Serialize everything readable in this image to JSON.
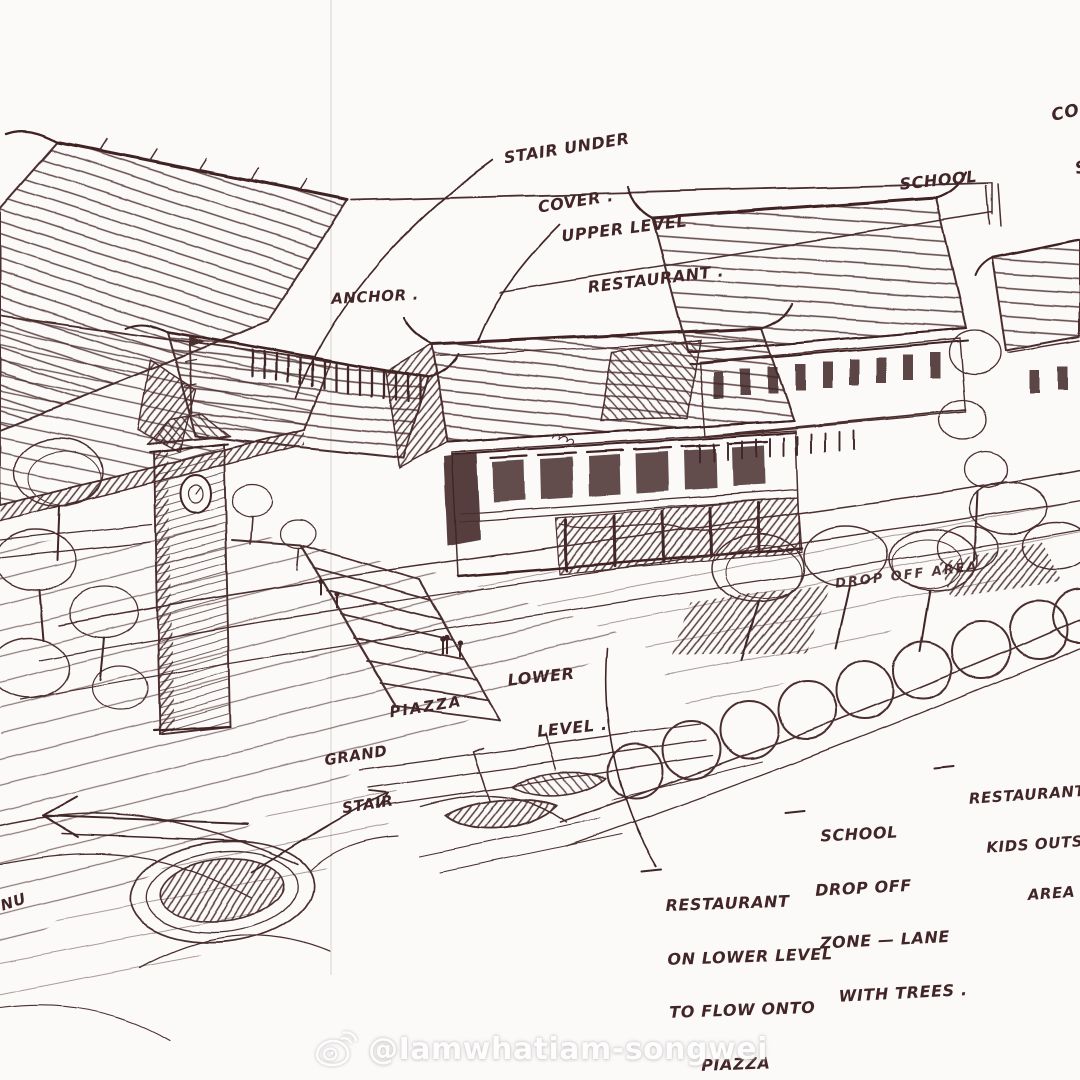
{
  "scene": {
    "type": "architectural-concept-sketch",
    "medium": "pen-on-paper perspective sketch",
    "subjects": [
      "anchor building with pitched roofs",
      "clock tower",
      "grand stair",
      "piazza with figures",
      "two-storey upper-level restaurant shophouse",
      "school building",
      "tree-lined drop-off lane",
      "row of round lane trees",
      "boats on water",
      "pond / roundabout",
      "road arrows"
    ]
  },
  "palette": {
    "ink": "#4b2e2e",
    "ink_dark": "#3f2424",
    "paper": "#fbfaf9",
    "crease": "#e8e3e1",
    "watermark": "#ffffff"
  },
  "annotations": {
    "stair_under_cover": {
      "lines": [
        "STAIR UNDER",
        "COVER ."
      ]
    },
    "upper_level_restaurant": {
      "lines": [
        "UPPER LEVEL",
        "RESTAURANT ."
      ]
    },
    "school": {
      "lines": [
        "SCHOOL"
      ]
    },
    "corner_cutoff": {
      "lines": [
        "CO",
        "S"
      ]
    },
    "anchor": {
      "lines": [
        "ANCHOR ."
      ]
    },
    "lower_level": {
      "lines": [
        "LOWER",
        "LEVEL ."
      ]
    },
    "piazza": {
      "lines": [
        "PIAZZA"
      ]
    },
    "grand_stair": {
      "lines": [
        "GRAND",
        "STAIR"
      ]
    },
    "drop_off_area": {
      "lines": [
        "DROP OFF AREA"
      ]
    },
    "restaurant_kids_outside": {
      "lines": [
        "RESTAURANT",
        "KIDS OUTSIDE",
        "AREA"
      ]
    },
    "school_drop_off_zone": {
      "lines": [
        "SCHOOL",
        "DROP OFF",
        "ZONE — LANE",
        "WITH TREES ."
      ]
    },
    "restaurant_flow": {
      "lines": [
        "RESTAURANT",
        "ON LOWER LEVEL",
        "TO FLOW ONTO",
        "PIAZZA"
      ]
    },
    "left_edge_cutoff": {
      "lines": [
        "NU"
      ]
    }
  },
  "watermark": {
    "handle": "@Iamwhatiam-songwei",
    "platform_icon": "weibo-icon"
  }
}
